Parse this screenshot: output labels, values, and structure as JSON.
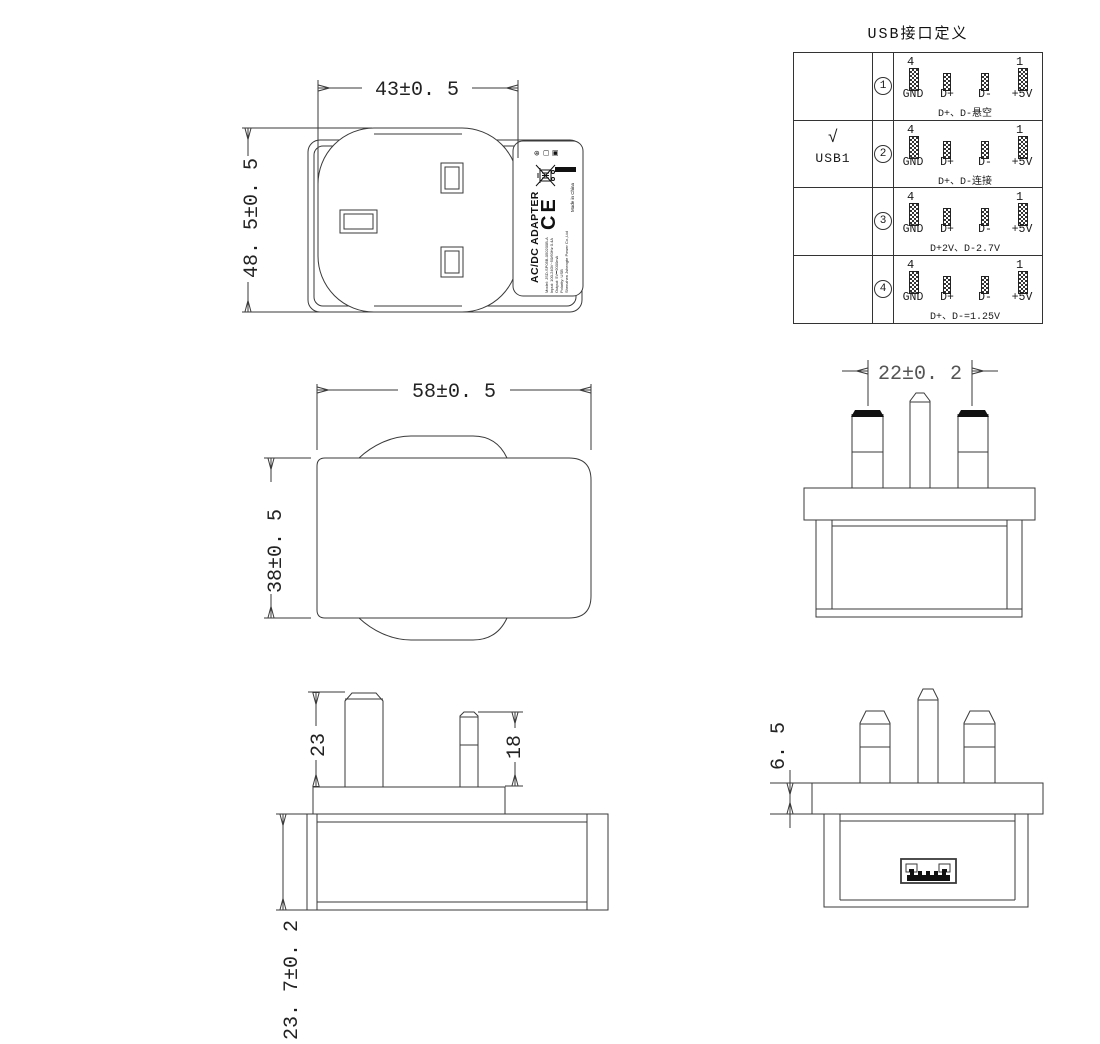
{
  "usb_table": {
    "title": "USB接口定义",
    "checked": {
      "mark": "√",
      "label": "USB1"
    },
    "pin_num_left": "4",
    "pin_num_right": "1",
    "pin_labels": [
      "GND",
      "D+",
      "D-",
      "+5V"
    ],
    "rows": [
      {
        "num": "1",
        "note": "D+、D-悬空"
      },
      {
        "num": "2",
        "note": "D+、D-连接"
      },
      {
        "num": "3",
        "note": "D+2V、D-2.7V"
      },
      {
        "num": "4",
        "note": "D+、D-=1.25V"
      }
    ]
  },
  "dimensions": {
    "front_width": "43±0. 5",
    "front_height": "48. 5±0. 5",
    "side_width": "58±0. 5",
    "side_height": "38±0. 5",
    "pin_spacing": "22±0. 2",
    "earth_pin_length": "23",
    "power_pin_length": "18",
    "body_depth": "23. 7±0. 2",
    "flange_thickness": "6. 5"
  },
  "label": {
    "title": "AC/DC ADAPTER",
    "lines": [
      "Model: JSD-SP05B-050200B-A",
      "Input: 100-240V~50/60Hz 0.4A",
      "Output: 5V⎓2000mA",
      "Polarity: USB",
      "Shenzhen Jshengte Power Co.,Ltd"
    ],
    "ce_mark": "CE",
    "made_in": "Made in China",
    "icons": {
      "cert": "⊛",
      "box": "▢",
      "square": "▣"
    }
  }
}
